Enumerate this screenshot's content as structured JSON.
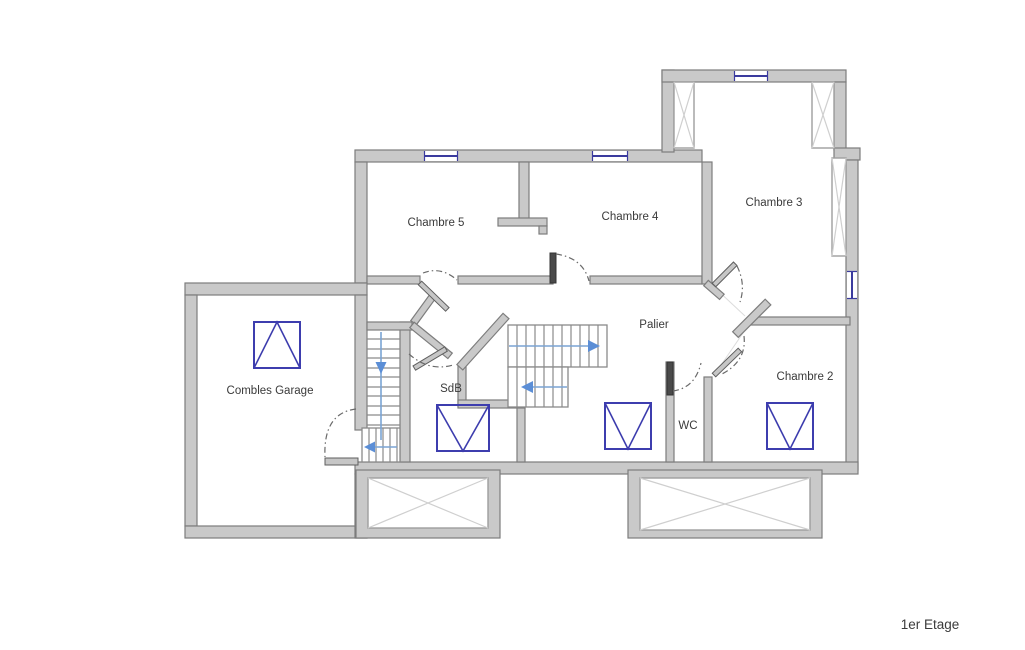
{
  "floor_plan": {
    "title": "1er Etage",
    "rooms": {
      "chambre5": {
        "label": "Chambre 5"
      },
      "chambre4": {
        "label": "Chambre 4"
      },
      "chambre3": {
        "label": "Chambre 3"
      },
      "chambre2": {
        "label": "Chambre 2"
      },
      "combles_garage": {
        "label": "Combles Garage"
      },
      "sdb": {
        "label": "SdB"
      },
      "wc": {
        "label": "WC"
      },
      "palier": {
        "label": "Palier"
      }
    },
    "colors": {
      "background": "#ffffff",
      "wall_fill": "#c9c9c9",
      "wall_stroke": "#7d7d7d",
      "window_glass": "#3b3b9e",
      "roof_window_symbol": "#3d3dae",
      "stair_guide_line": "#7aa3d4",
      "stair_arrow": "#5b8ed6",
      "door_arc": "#6a6a6a",
      "label_text": "#3a3a3a"
    }
  }
}
